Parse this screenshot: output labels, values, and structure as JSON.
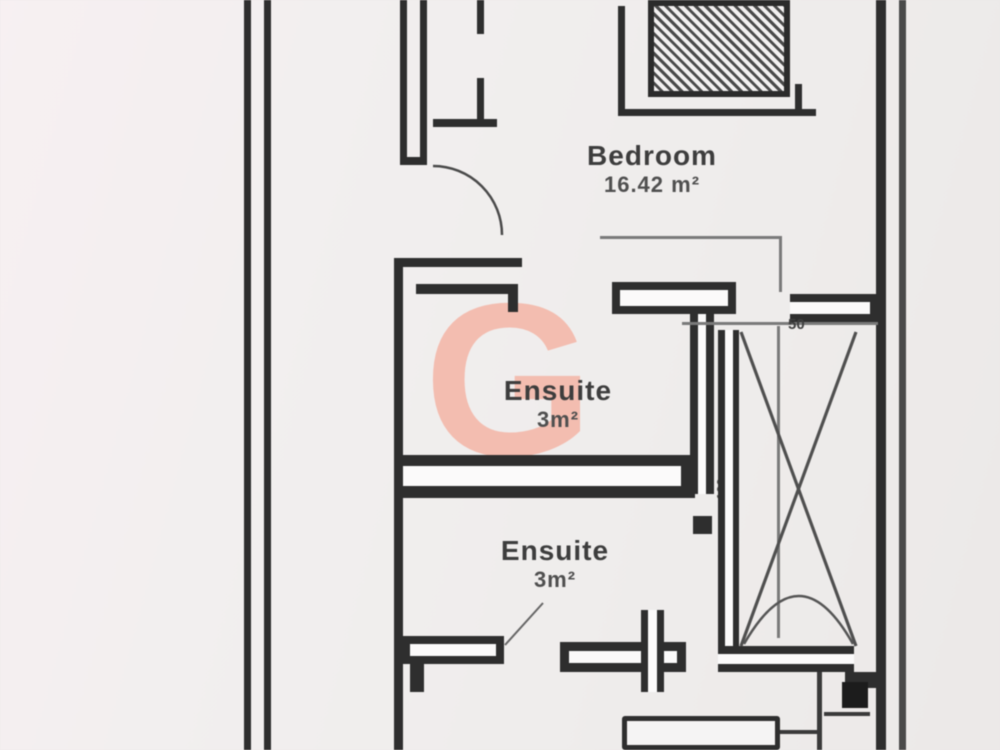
{
  "plan": {
    "title": "floor-plan",
    "rooms": [
      {
        "name": "Bedroom",
        "area": "16.42 m²"
      },
      {
        "name": "Ensuite",
        "area": "3m²"
      },
      {
        "name": "Ensuite",
        "area": "3m²"
      }
    ],
    "dimensions": {
      "shaft_width": "50",
      "shaft_depth": "100"
    },
    "watermark": "G",
    "colors": {
      "wall": "#2e2e2e",
      "thin_line": "#7a7a7a",
      "watermark": "#f4b9ab",
      "background": "#f1eeee"
    }
  }
}
